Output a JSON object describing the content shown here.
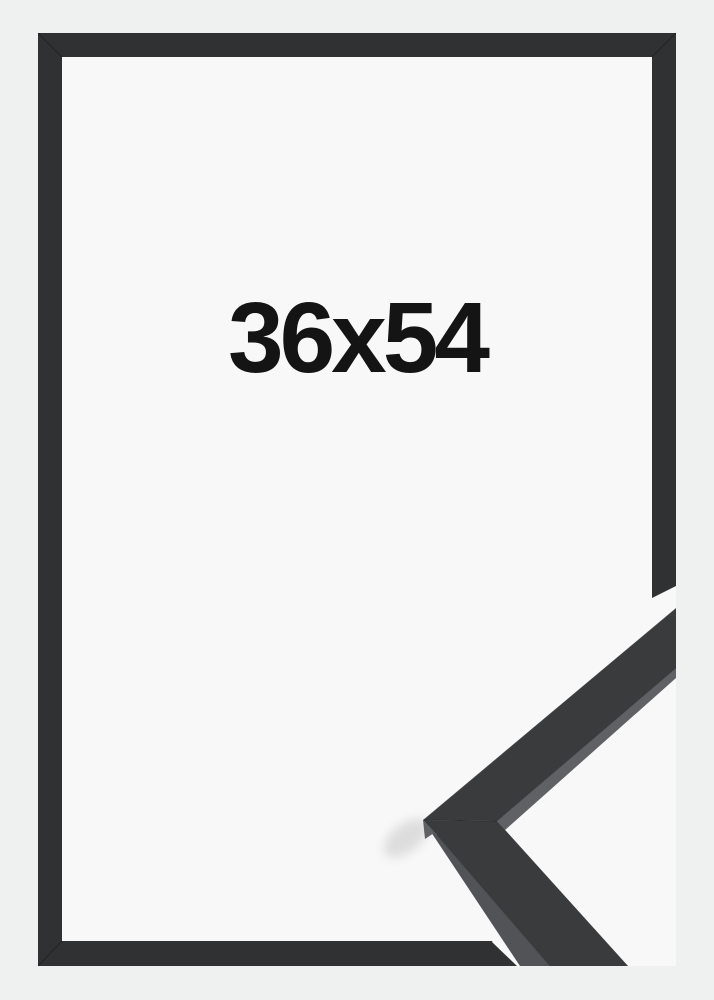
{
  "product_photo": {
    "size_label": "36x54",
    "colors": {
      "background": "#eff0f0",
      "interior": "#f8f8f8",
      "frame": "#303132",
      "moulding_face": "#3a3b3d",
      "moulding_side": "#525357",
      "moulding_lip": "#606165",
      "label_text": "#141414"
    }
  }
}
